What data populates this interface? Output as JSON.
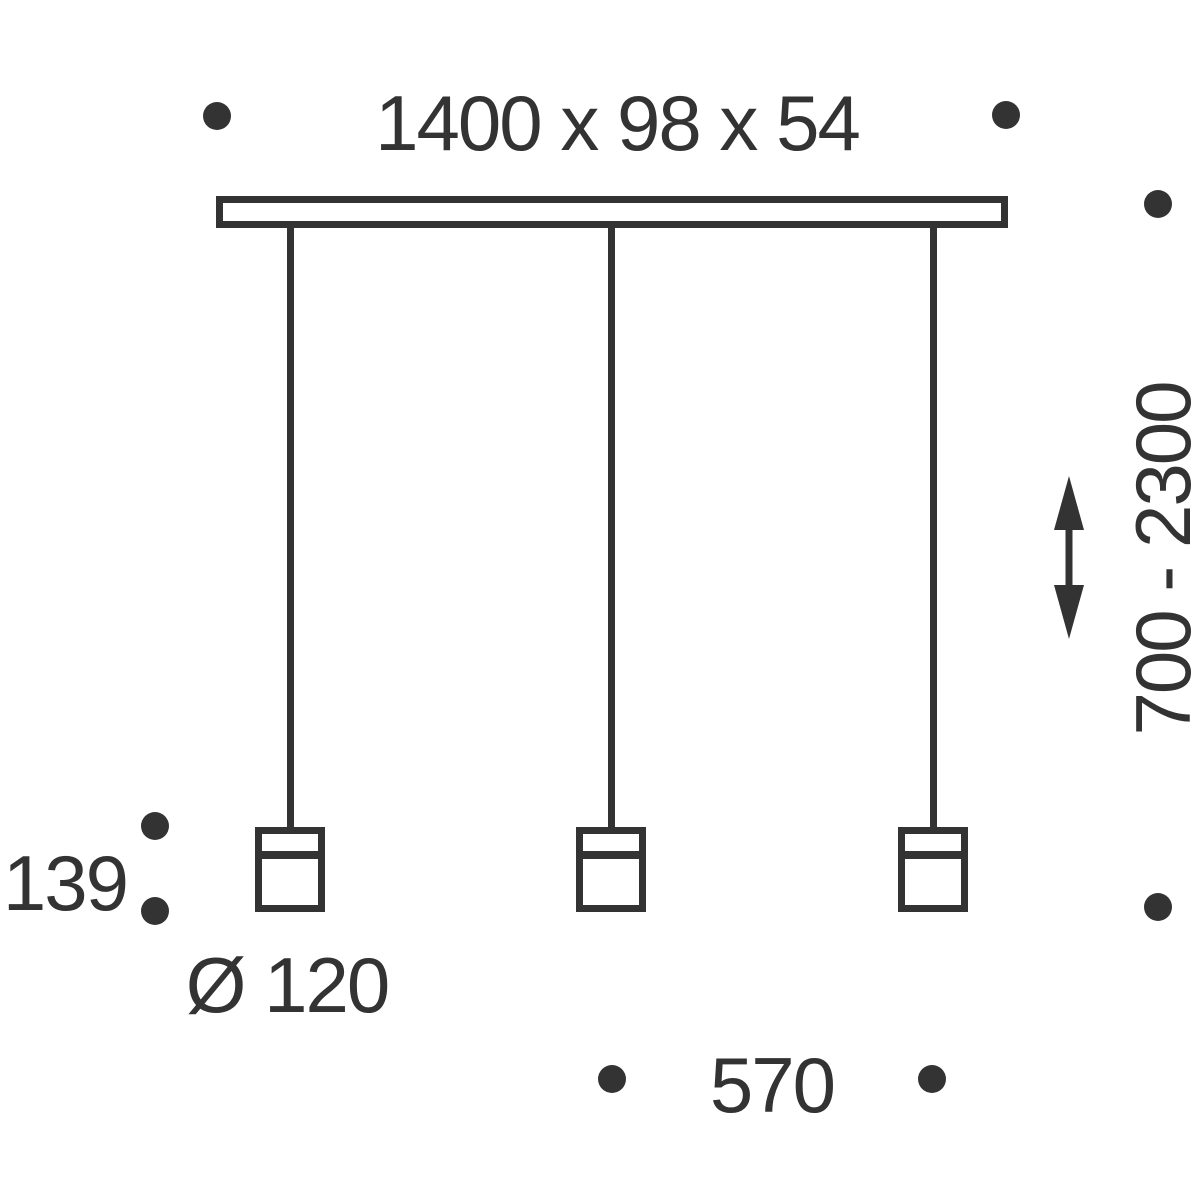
{
  "diagram": {
    "canopy_dimensions": "1400 x 98 x 54",
    "suspension_height_range": "700 - 2300",
    "pendant_height": "139",
    "shade_diameter": "Ø 120",
    "lamp_spacing": "570"
  },
  "icons": {
    "height_adjust": "double-vertical-arrow-icon",
    "reference_marker": "dot-icon"
  },
  "colors": {
    "line": "#333333",
    "background": "#ffffff"
  }
}
